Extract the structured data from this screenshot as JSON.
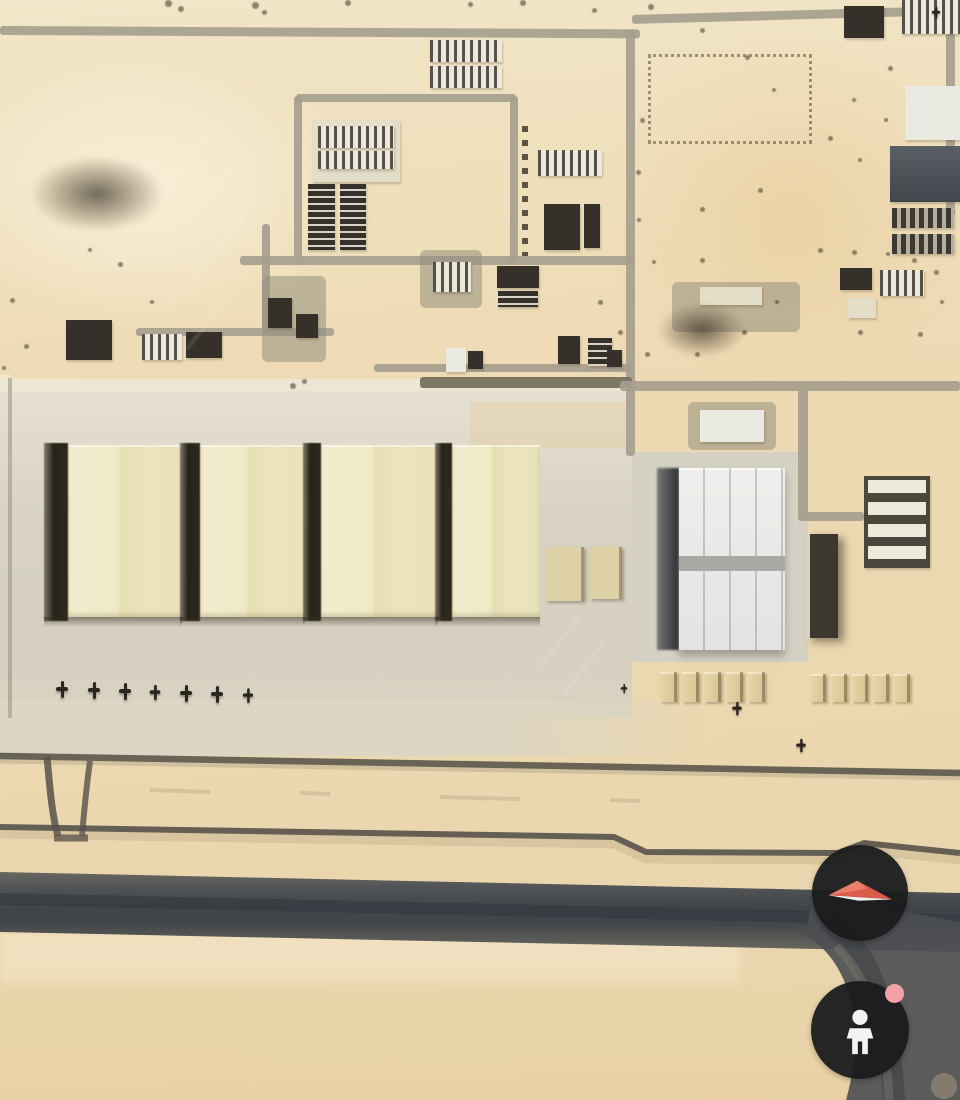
{
  "view": {
    "type": "satellite-aerial-3d"
  },
  "controls": {
    "compass": {
      "icon": "compass-needle-icon"
    },
    "street_view": {
      "icon": "pegman-icon",
      "badge_icon": "availability-dot"
    }
  },
  "colors": {
    "sand": "#ecd9b2",
    "apron": "#d8d3c3",
    "hangar_roof": "#ede7c4",
    "hangar_shadow": "#2f2c25",
    "white_hangar_roof": "#eaebe7",
    "runway": "#3c4046",
    "road": "#a69f8e",
    "shelter_tan": "#dbc795",
    "building_dark": "#35312a",
    "building_white": "#eceae2",
    "slate_roof": "#4d5158",
    "button_bg": "#1b1b1d",
    "compass_red": "#dc5c49",
    "compass_white": "#f3f1ee",
    "pegman_white": "#f3f3f1",
    "street_view_dot": "#f2a2a6"
  },
  "features": {
    "roads": [
      {
        "x": 0,
        "y": 26,
        "w": 640,
        "h": 9,
        "r": 0.3
      },
      {
        "x": 632,
        "y": 15,
        "w": 330,
        "h": 9,
        "r": -1.6
      },
      {
        "x": 626,
        "y": 30,
        "w": 9,
        "h": 360
      },
      {
        "x": 946,
        "y": 28,
        "w": 9,
        "h": 188
      },
      {
        "x": 420,
        "y": 377,
        "w": 212,
        "h": 11,
        "v": "dark"
      },
      {
        "x": 620,
        "y": 381,
        "w": 340,
        "h": 10
      },
      {
        "x": 798,
        "y": 390,
        "w": 10,
        "h": 130
      },
      {
        "x": 798,
        "y": 512,
        "w": 66,
        "h": 9
      },
      {
        "x": 294,
        "y": 96,
        "w": 8,
        "h": 162
      },
      {
        "x": 296,
        "y": 94,
        "w": 220,
        "h": 8
      },
      {
        "x": 510,
        "y": 96,
        "w": 8,
        "h": 166
      },
      {
        "x": 240,
        "y": 256,
        "w": 394,
        "h": 9
      },
      {
        "x": 136,
        "y": 328,
        "w": 198,
        "h": 8
      },
      {
        "x": 374,
        "y": 364,
        "w": 258,
        "h": 8
      },
      {
        "x": 262,
        "y": 224,
        "w": 8,
        "h": 110
      },
      {
        "x": 626,
        "y": 388,
        "w": 9,
        "h": 68
      }
    ],
    "structures": [
      {
        "x": 430,
        "y": 40,
        "w": 72,
        "h": 22,
        "t": "white-striped"
      },
      {
        "x": 430,
        "y": 66,
        "w": 72,
        "h": 22,
        "t": "white-striped"
      },
      {
        "x": 312,
        "y": 120,
        "w": 88,
        "h": 62,
        "t": "pale"
      },
      {
        "x": 318,
        "y": 126,
        "w": 76,
        "h": 22,
        "t": "white-striped"
      },
      {
        "x": 318,
        "y": 151,
        "w": 76,
        "h": 18,
        "t": "white-striped"
      },
      {
        "x": 308,
        "y": 184,
        "w": 27,
        "h": 66,
        "t": "dark-striped"
      },
      {
        "x": 340,
        "y": 184,
        "w": 26,
        "h": 66,
        "t": "dark-striped"
      },
      {
        "x": 538,
        "y": 150,
        "w": 64,
        "h": 26,
        "t": "white-striped"
      },
      {
        "x": 544,
        "y": 204,
        "w": 36,
        "h": 46,
        "t": "dark"
      },
      {
        "x": 584,
        "y": 204,
        "w": 16,
        "h": 44,
        "t": "dark"
      },
      {
        "x": 420,
        "y": 250,
        "w": 62,
        "h": 58,
        "t": "compound"
      },
      {
        "x": 433,
        "y": 262,
        "w": 38,
        "h": 30,
        "t": "white-striped"
      },
      {
        "x": 497,
        "y": 266,
        "w": 42,
        "h": 22,
        "t": "dark"
      },
      {
        "x": 498,
        "y": 291,
        "w": 40,
        "h": 16,
        "t": "dark-striped"
      },
      {
        "x": 66,
        "y": 320,
        "w": 46,
        "h": 40,
        "t": "dark"
      },
      {
        "x": 142,
        "y": 334,
        "w": 40,
        "h": 26,
        "t": "white-striped"
      },
      {
        "x": 186,
        "y": 332,
        "w": 36,
        "h": 26,
        "t": "dark"
      },
      {
        "x": 262,
        "y": 276,
        "w": 64,
        "h": 86,
        "t": "compound"
      },
      {
        "x": 268,
        "y": 298,
        "w": 24,
        "h": 30,
        "t": "dark"
      },
      {
        "x": 296,
        "y": 314,
        "w": 22,
        "h": 24,
        "t": "dark"
      },
      {
        "x": 648,
        "y": 54,
        "w": 158,
        "h": 84,
        "t": "lot"
      },
      {
        "x": 902,
        "y": 0,
        "w": 58,
        "h": 34,
        "t": "white-striped"
      },
      {
        "x": 905,
        "y": 86,
        "w": 55,
        "h": 54,
        "t": "white"
      },
      {
        "x": 890,
        "y": 146,
        "w": 70,
        "h": 56,
        "t": "slate"
      },
      {
        "x": 892,
        "y": 208,
        "w": 62,
        "h": 20,
        "t": "carport"
      },
      {
        "x": 892,
        "y": 234,
        "w": 62,
        "h": 20,
        "t": "carport"
      },
      {
        "x": 844,
        "y": 6,
        "w": 40,
        "h": 32,
        "t": "dark"
      },
      {
        "x": 840,
        "y": 268,
        "w": 32,
        "h": 22,
        "t": "dark"
      },
      {
        "x": 880,
        "y": 270,
        "w": 44,
        "h": 26,
        "t": "white-striped"
      },
      {
        "x": 848,
        "y": 298,
        "w": 28,
        "h": 20,
        "t": "pale"
      },
      {
        "x": 672,
        "y": 282,
        "w": 128,
        "h": 50,
        "t": "compound"
      },
      {
        "x": 700,
        "y": 287,
        "w": 62,
        "h": 18,
        "t": "pale"
      },
      {
        "x": 658,
        "y": 303,
        "w": 88,
        "h": 54,
        "t": "smudge"
      },
      {
        "x": 30,
        "y": 156,
        "w": 134,
        "h": 76,
        "t": "smudge"
      },
      {
        "x": 446,
        "y": 348,
        "w": 20,
        "h": 24,
        "t": "white"
      },
      {
        "x": 468,
        "y": 351,
        "w": 15,
        "h": 18,
        "t": "dark"
      },
      {
        "x": 558,
        "y": 336,
        "w": 22,
        "h": 28,
        "t": "dark"
      },
      {
        "x": 588,
        "y": 338,
        "w": 24,
        "h": 28,
        "t": "dark-striped"
      },
      {
        "x": 607,
        "y": 350,
        "w": 15,
        "h": 17,
        "t": "dark"
      },
      {
        "x": 688,
        "y": 402,
        "w": 88,
        "h": 48,
        "t": "compound"
      },
      {
        "x": 700,
        "y": 410,
        "w": 64,
        "h": 32,
        "t": "white"
      },
      {
        "x": 864,
        "y": 476,
        "w": 66,
        "h": 92,
        "t": "barracks4"
      },
      {
        "x": 806,
        "y": 534,
        "w": 32,
        "h": 104,
        "t": "dark-edge"
      },
      {
        "x": 546,
        "y": 547,
        "w": 38,
        "h": 54,
        "t": "tan"
      },
      {
        "x": 590,
        "y": 547,
        "w": 32,
        "h": 52,
        "t": "tan"
      },
      {
        "x": 522,
        "y": 126,
        "w": 6,
        "h": 130,
        "t": "treeline"
      }
    ],
    "hangar_row": {
      "y": 445,
      "h": 172,
      "items": [
        {
          "x": 68,
          "w": 114,
          "sw": 24
        },
        {
          "x": 200,
          "w": 105,
          "sw": 20
        },
        {
          "x": 321,
          "w": 117,
          "sw": 18
        },
        {
          "x": 452,
          "w": 88,
          "sw": 17
        }
      ]
    },
    "shelter_groups": [
      {
        "x": 660,
        "y": 672,
        "n": 5,
        "w": 17,
        "h": 30,
        "g": 5
      },
      {
        "x": 810,
        "y": 674,
        "n": 5,
        "w": 16,
        "h": 28,
        "g": 5
      }
    ],
    "aircraft": [
      {
        "x": 56,
        "y": 681
      },
      {
        "x": 88,
        "y": 682
      },
      {
        "x": 119,
        "y": 683
      },
      {
        "x": 149,
        "y": 684,
        "s": 0.9
      },
      {
        "x": 180,
        "y": 685
      },
      {
        "x": 211,
        "y": 686
      },
      {
        "x": 242,
        "y": 687,
        "s": 0.85
      },
      {
        "x": 731,
        "y": 700,
        "s": 0.8
      },
      {
        "x": 795,
        "y": 737,
        "s": 0.8
      },
      {
        "x": 618,
        "y": 680,
        "s": 0.55
      },
      {
        "x": 930,
        "y": 4,
        "s": 0.7
      }
    ],
    "vegetation_dots": [
      {
        "x": 165,
        "y": 0,
        "s": 7
      },
      {
        "x": 178,
        "y": 6,
        "s": 6
      },
      {
        "x": 252,
        "y": 2,
        "s": 7
      },
      {
        "x": 262,
        "y": 10,
        "s": 5
      },
      {
        "x": 345,
        "y": 0,
        "s": 6
      },
      {
        "x": 468,
        "y": 2,
        "s": 5
      },
      {
        "x": 520,
        "y": 0,
        "s": 6
      },
      {
        "x": 592,
        "y": 8,
        "s": 5
      },
      {
        "x": 648,
        "y": 4,
        "s": 6
      },
      {
        "x": 700,
        "y": 28,
        "s": 5
      },
      {
        "x": 745,
        "y": 55,
        "s": 5
      },
      {
        "x": 772,
        "y": 88,
        "s": 4
      },
      {
        "x": 640,
        "y": 118,
        "s": 5
      },
      {
        "x": 636,
        "y": 170,
        "s": 5
      },
      {
        "x": 637,
        "y": 218,
        "s": 4
      },
      {
        "x": 700,
        "y": 207,
        "s": 5
      },
      {
        "x": 758,
        "y": 188,
        "s": 5
      },
      {
        "x": 700,
        "y": 258,
        "s": 5
      },
      {
        "x": 652,
        "y": 260,
        "s": 4
      },
      {
        "x": 818,
        "y": 248,
        "s": 5
      },
      {
        "x": 852,
        "y": 250,
        "s": 5
      },
      {
        "x": 886,
        "y": 252,
        "s": 4
      },
      {
        "x": 912,
        "y": 258,
        "s": 5
      },
      {
        "x": 934,
        "y": 270,
        "s": 5
      },
      {
        "x": 598,
        "y": 300,
        "s": 5
      },
      {
        "x": 618,
        "y": 330,
        "s": 5
      },
      {
        "x": 645,
        "y": 352,
        "s": 5
      },
      {
        "x": 695,
        "y": 352,
        "s": 5
      },
      {
        "x": 742,
        "y": 330,
        "s": 5
      },
      {
        "x": 775,
        "y": 300,
        "s": 4
      },
      {
        "x": 858,
        "y": 330,
        "s": 5
      },
      {
        "x": 918,
        "y": 332,
        "s": 5
      },
      {
        "x": 940,
        "y": 300,
        "s": 4
      },
      {
        "x": 888,
        "y": 66,
        "s": 5
      },
      {
        "x": 852,
        "y": 98,
        "s": 4
      },
      {
        "x": 828,
        "y": 136,
        "s": 5
      },
      {
        "x": 858,
        "y": 158,
        "s": 4
      },
      {
        "x": 884,
        "y": 118,
        "s": 4
      },
      {
        "x": 10,
        "y": 298,
        "s": 5
      },
      {
        "x": 24,
        "y": 344,
        "s": 5
      },
      {
        "x": 2,
        "y": 366,
        "s": 4
      },
      {
        "x": 150,
        "y": 300,
        "s": 4
      },
      {
        "x": 118,
        "y": 262,
        "s": 5
      },
      {
        "x": 88,
        "y": 248,
        "s": 4
      },
      {
        "x": 290,
        "y": 383,
        "s": 6
      },
      {
        "x": 302,
        "y": 379,
        "s": 5
      }
    ],
    "watermark_streaks": [
      {
        "x": 196,
        "y": 118
      },
      {
        "x": 214,
        "y": 156
      },
      {
        "x": 232,
        "y": 196
      },
      {
        "x": 186,
        "y": 252
      },
      {
        "x": 205,
        "y": 292
      },
      {
        "x": 560,
        "y": 608
      },
      {
        "x": 582,
        "y": 636
      }
    ]
  }
}
